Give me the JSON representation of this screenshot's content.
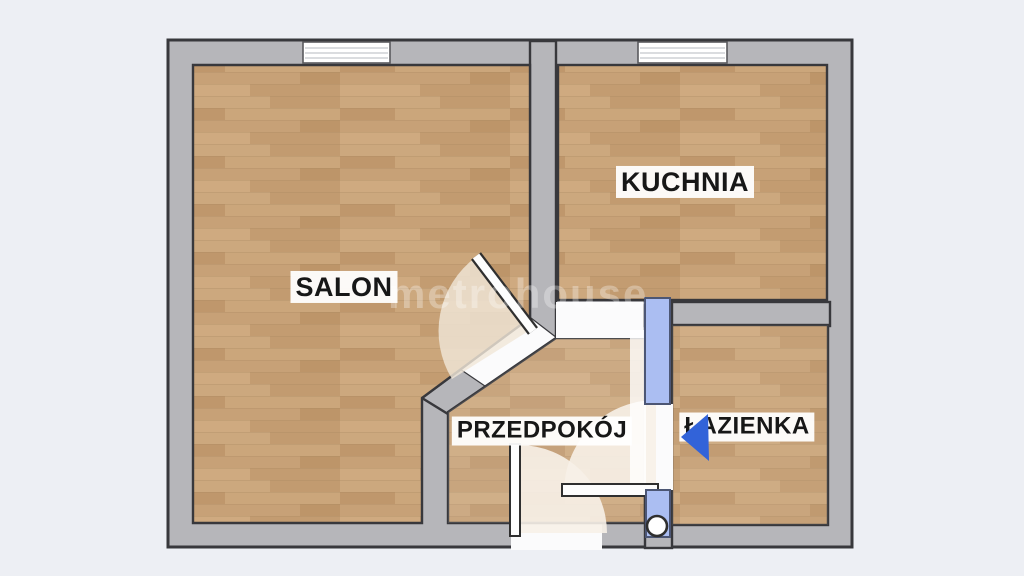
{
  "watermark": "metrohouse",
  "rooms": [
    {
      "name": "SALON"
    },
    {
      "name": "KUCHNIA"
    },
    {
      "name": "PRZEDPOKÓJ"
    },
    {
      "name": "ŁAZIENKA"
    }
  ],
  "colors": {
    "background": "#edeff4",
    "wall": "#b6b6ba",
    "outline": "#38383c",
    "floor_base": "#c6a075",
    "opening": "#fbfbfc",
    "swing": "#f0e6d8",
    "door_blue": "#abbef2",
    "door_blue_outline": "#4c5674",
    "arrow_blue": "#3263d9",
    "leaf_white": "#fdfdfd"
  }
}
